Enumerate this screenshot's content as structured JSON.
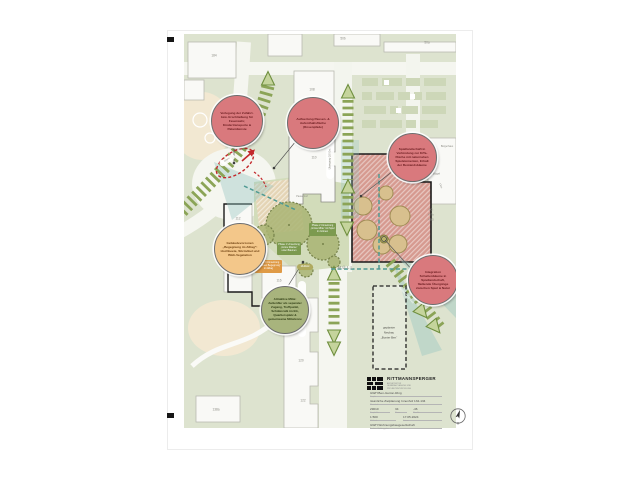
{
  "map": {
    "building_labels": [
      "184",
      "50b",
      "50a",
      "108",
      "110",
      "112",
      "114",
      "116",
      "118",
      "120",
      "122",
      "138a"
    ],
    "places": {
      "zentrum": "Zentrum",
      "am_buegel": "Am Bügel",
      "buergerhaus": "Bürgerhaus",
      "b110a": "110a",
      "eg": "EG:",
      "kita": "KiTa",
      "abg": "ABG",
      "muell": "MÜLL",
      "pausenhof": "Pausenhof"
    },
    "pills": {
      "qs_ost": "Übergang QS Ost",
      "tiefgarage": "Übergang Tiefgarage",
      "zufahrt": "Zufahrt",
      "verbindung": "Verbindung QS-See"
    },
    "neubau": {
      "l1": "geplanter",
      "l2": "Neubau",
      "l3": "„Bunter Ben“"
    },
    "bubbles": [
      {
        "id": "verlegung-zufahrt",
        "text": "Verlegung der Zufahrt- bzw. Erschließung für Feuerwehr, Kindertransporte & Paketdienste"
      },
      {
        "id": "aufwertung-pausenflaeche",
        "text": "Aufwertung Pausen- & Aufenthaltsfläche (Rosenpfade)"
      },
      {
        "id": "spiellandschaft",
        "text": "Spiellandschaft in Verbindung zur KiTa-Fläche mit naturnahen Spielelementen, Erhalt der Bestandsbäume"
      },
      {
        "id": "gebaeudevorzonen",
        "text": "Gebäudevorzonen „Begegnung im Alltag“: Hochbeete, Sitzmöbel und Blüh-Vegetation"
      },
      {
        "id": "attraktive-mitte",
        "text": "Attraktive Mitte: Außenflur als separater Zugang, Treffpunkt, Schülercafé im EG, Quartiersplatz & gemeinsame Mittelzone"
      },
      {
        "id": "integration-schattenbaeume",
        "text": "Integration Schattenbäume in Spiellandschaft, fließende Übergänge zwischen Spiel & Natur"
      }
    ],
    "phase_boxes": [
      {
        "text": "Phase 2 Umsetzung „Grüne Mitte“ mit Spiel im Grünen"
      },
      {
        "text": "Phase 1 Umsetzung „Grüne Räume“ unter Bäumen"
      },
      {
        "text": "Phase 3 Umsetzung „Vorzonen Begegnung“ im Alltag"
      },
      {
        "text": "Multifeld"
      }
    ]
  },
  "titleblock": {
    "firm": "RITTMANNSPERGER",
    "firm_line1": "ARCHITEKTUR",
    "firm_line2": "GENERALPLANUNG UND",
    "firm_line3": "PROJEKTENTWICKLUNG",
    "project": "GWH Ben-Gurion-Ring",
    "project_label": "Projekt",
    "content": "räumliche Zielplanung Innenhof 132-134",
    "content_label": "Planinhalt",
    "num1": "29010",
    "num1_label": "Projekt-Nr.",
    "num2": "34",
    "num2_label": "Phase",
    "num3": "-46",
    "num3_label": "Plan-Nr.",
    "scale": "1:500",
    "scale_label": "Maßstab",
    "date": "17.05.2024",
    "date_label": "Datum",
    "client": "GWH Wohnungsbaugesellschaft",
    "client_label": "Bauherr / Auftraggeber"
  }
}
